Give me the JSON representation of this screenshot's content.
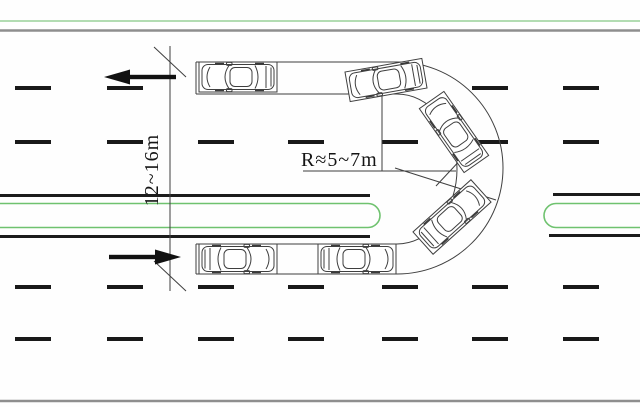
{
  "diagram": {
    "labels": {
      "opening_length": "12~16m",
      "turn_radius": "R≈5~7m"
    },
    "colors": {
      "background": "#fefefe",
      "road_edge_gray": "#8e8e8e",
      "roadside_green": "#b2dcb2",
      "median_green": "#6fc26f",
      "median_line_black": "#1c1c1c",
      "lane_marking_black": "#191919",
      "drawing_line": "#3f3f3f",
      "arrow_black": "#111111"
    },
    "lane_markings": {
      "dash_width": 36,
      "dash_height": 4,
      "rows": [
        {
          "y": 86,
          "x": [
            15,
            107,
            472,
            563
          ]
        },
        {
          "y": 140,
          "x": [
            15,
            107,
            198,
            288,
            382,
            472,
            563
          ]
        },
        {
          "y": 285,
          "x": [
            15,
            107,
            198,
            288,
            382,
            472,
            563
          ]
        },
        {
          "y": 337,
          "x": [
            15,
            107,
            198,
            288,
            382,
            472,
            563
          ]
        }
      ]
    },
    "cars": [
      {
        "id": "car-exit-top-left",
        "cx": 238,
        "cy": 77,
        "rot": 180
      },
      {
        "id": "car-exiting-curve-top",
        "cx": 386,
        "cy": 80,
        "rot": 170
      },
      {
        "id": "car-curve-upper-right",
        "cx": 454,
        "cy": 132,
        "rot": -125
      },
      {
        "id": "car-curve-lower-right",
        "cx": 452,
        "cy": 217,
        "rot": -42
      },
      {
        "id": "car-entering-curve-bottom",
        "cx": 357,
        "cy": 259,
        "rot": 0
      },
      {
        "id": "car-entry-bottom-left",
        "cx": 238,
        "cy": 259,
        "rot": 0
      }
    ],
    "arrows": [
      {
        "id": "arrow-westbound",
        "dir": "left",
        "tipX": 104,
        "tipY": 77,
        "len": 72
      },
      {
        "id": "arrow-eastbound",
        "dir": "right",
        "tipX": 181,
        "tipY": 257,
        "len": 72
      }
    ]
  }
}
